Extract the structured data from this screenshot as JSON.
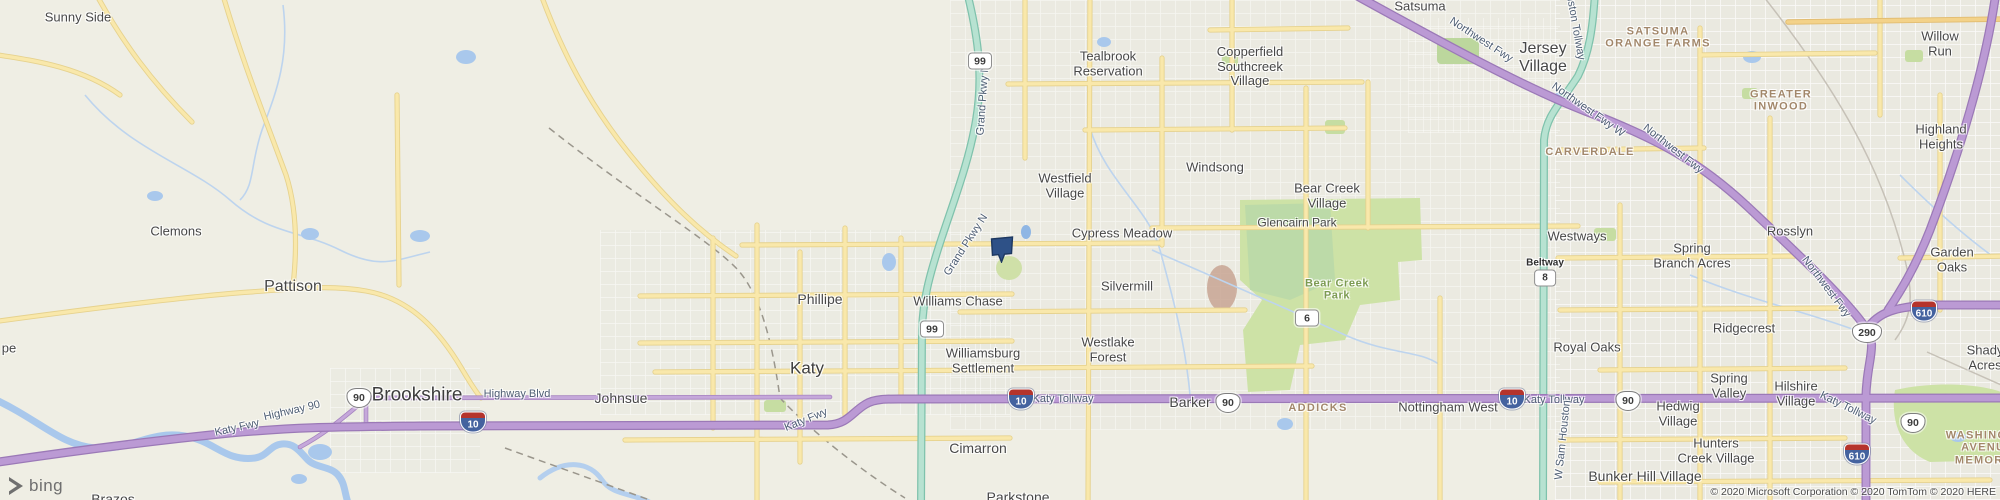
{
  "map": {
    "provider_logo_text": "bing",
    "attribution": "© 2020 Microsoft Corporation © 2020 TomTom © 2020 HERE",
    "colors": {
      "background": "#efeee4",
      "freeway_purple": "#bb9ad4",
      "freeway_purple_casing": "#9b79b7",
      "tollway_teal": "#b7e2d1",
      "tollway_teal_casing": "#7fc2ac",
      "road_yellow": "#f9e8ab",
      "park_green": "#cde2a6",
      "water_blue": "#a9c8ec",
      "marker_navy": "#2e5187"
    },
    "marker": {
      "x": 1002,
      "y": 249
    },
    "labels": [
      {
        "id": "sunny-side",
        "text": "Sunny Side",
        "x": 78,
        "y": 18,
        "cls": "town"
      },
      {
        "id": "clemons",
        "text": "Clemons",
        "x": 176,
        "y": 232,
        "cls": "town"
      },
      {
        "id": "pe-partial",
        "text": "pe",
        "x": 9,
        "y": 349,
        "cls": "town"
      },
      {
        "id": "pattison",
        "text": "Pattison",
        "x": 293,
        "y": 287,
        "cls": "town",
        "fs": 16
      },
      {
        "id": "brookshire",
        "text": "Brookshire",
        "x": 417,
        "y": 395,
        "cls": "city",
        "fs": 19
      },
      {
        "id": "johnsue",
        "text": "Johnsue",
        "x": 621,
        "y": 399,
        "cls": "town",
        "fs": 14
      },
      {
        "id": "katy",
        "text": "Katy",
        "x": 807,
        "y": 368,
        "cls": "city"
      },
      {
        "id": "phillipe",
        "text": "Phillipe",
        "x": 820,
        "y": 300,
        "cls": "town",
        "fs": 14
      },
      {
        "id": "williams-chase",
        "text": "Williams Chase",
        "x": 958,
        "y": 302,
        "cls": "town"
      },
      {
        "id": "williamsburg-settlement",
        "text": "Williamsburg\nSettlement",
        "x": 983,
        "y": 361,
        "cls": "town"
      },
      {
        "id": "cimarron",
        "text": "Cimarron",
        "x": 978,
        "y": 449,
        "cls": "town",
        "fs": 14
      },
      {
        "id": "parkstone",
        "text": "Parkstone",
        "x": 1018,
        "y": 498,
        "cls": "town",
        "fs": 14
      },
      {
        "id": "brazos",
        "text": "Brazos",
        "x": 113,
        "y": 500,
        "cls": "town",
        "fs": 14
      },
      {
        "id": "tealbrook-reservation",
        "text": "Tealbrook\nReservation",
        "x": 1108,
        "y": 64,
        "cls": "town"
      },
      {
        "id": "copperfield-southcreek-village",
        "text": "Copperfield\nSouthcreek\nVillage",
        "x": 1250,
        "y": 67,
        "cls": "town"
      },
      {
        "id": "westfield-village",
        "text": "Westfield\nVillage",
        "x": 1065,
        "y": 186,
        "cls": "town"
      },
      {
        "id": "windsong",
        "text": "Windsong",
        "x": 1215,
        "y": 168,
        "cls": "town"
      },
      {
        "id": "cypress-meadow",
        "text": "Cypress Meadow",
        "x": 1122,
        "y": 234,
        "cls": "town"
      },
      {
        "id": "silvermill",
        "text": "Silvermill",
        "x": 1127,
        "y": 287,
        "cls": "town"
      },
      {
        "id": "bear-creek-village",
        "text": "Bear Creek\nVillage",
        "x": 1327,
        "y": 196,
        "cls": "town"
      },
      {
        "id": "glencairn-park",
        "text": "Glencairn Park",
        "x": 1297,
        "y": 223,
        "cls": "town",
        "fs": 12
      },
      {
        "id": "westlake-forest",
        "text": "Westlake\nForest",
        "x": 1108,
        "y": 350,
        "cls": "town"
      },
      {
        "id": "satsuma",
        "text": "Satsuma",
        "x": 1420,
        "y": 7,
        "cls": "town"
      },
      {
        "id": "jersey-village",
        "text": "Jersey\nVillage",
        "x": 1543,
        "y": 58,
        "cls": "town",
        "fs": 16
      },
      {
        "id": "willow-run",
        "text": "Willow Run",
        "x": 1940,
        "y": 44,
        "cls": "town"
      },
      {
        "id": "highland-heights",
        "text": "Highland\nHeights",
        "x": 1941,
        "y": 137,
        "cls": "town"
      },
      {
        "id": "westways",
        "text": "Westways",
        "x": 1577,
        "y": 237,
        "cls": "town"
      },
      {
        "id": "spring-branch-acres",
        "text": "Spring\nBranch Acres",
        "x": 1692,
        "y": 256,
        "cls": "town"
      },
      {
        "id": "rosslyn",
        "text": "Rosslyn",
        "x": 1790,
        "y": 232,
        "cls": "town"
      },
      {
        "id": "garden-oaks",
        "text": "Garden Oaks",
        "x": 1952,
        "y": 260,
        "cls": "town"
      },
      {
        "id": "ridgecrest",
        "text": "Ridgecrest",
        "x": 1744,
        "y": 329,
        "cls": "town"
      },
      {
        "id": "royal-oaks",
        "text": "Royal Oaks",
        "x": 1587,
        "y": 348,
        "cls": "town"
      },
      {
        "id": "spring-valley",
        "text": "Spring\nValley",
        "x": 1729,
        "y": 386,
        "cls": "town"
      },
      {
        "id": "hilshire-village",
        "text": "Hilshire\nVillage",
        "x": 1796,
        "y": 394,
        "cls": "town"
      },
      {
        "id": "hedwig-village",
        "text": "Hedwig\nVillage",
        "x": 1678,
        "y": 414,
        "cls": "town"
      },
      {
        "id": "nottingham-west",
        "text": "Nottingham West",
        "x": 1448,
        "y": 408,
        "cls": "town"
      },
      {
        "id": "barker",
        "text": "Barker",
        "x": 1190,
        "y": 403,
        "cls": "town",
        "fs": 14
      },
      {
        "id": "hunters-creek-village",
        "text": "Hunters\nCreek Village",
        "x": 1716,
        "y": 451,
        "cls": "town"
      },
      {
        "id": "bunker-hill-village",
        "text": "Bunker Hill Village",
        "x": 1645,
        "y": 477,
        "cls": "town",
        "fs": 14
      },
      {
        "id": "shady-acres",
        "text": "Shady Acres",
        "x": 1985,
        "y": 358,
        "cls": "town"
      },
      {
        "id": "satsuma-orange-farms",
        "text": "SATSUMA\nORANGE FARMS",
        "x": 1658,
        "y": 38,
        "cls": "area"
      },
      {
        "id": "greater-inwood",
        "text": "GREATER\nINWOOD",
        "x": 1781,
        "y": 101,
        "cls": "area"
      },
      {
        "id": "carverdale",
        "text": "CARVERDALE",
        "x": 1590,
        "y": 152,
        "cls": "area"
      },
      {
        "id": "addicks",
        "text": "ADDICKS",
        "x": 1318,
        "y": 408,
        "cls": "area"
      },
      {
        "id": "washington-avenue-memorial",
        "text": "WASHINGTON\nAVENUE-MEMORIAL",
        "x": 1990,
        "y": 448,
        "cls": "area"
      },
      {
        "id": "bear-creek-park",
        "text": "Bear Creek\nPark",
        "x": 1337,
        "y": 290,
        "cls": "park-label"
      },
      {
        "id": "highway-blvd",
        "text": "Highway Blvd",
        "x": 517,
        "y": 394,
        "cls": "roadlbl"
      },
      {
        "id": "katy-fwy-west",
        "text": "Katy Fwy",
        "x": 237,
        "y": 428,
        "cls": "roadlbl",
        "rot": -13
      },
      {
        "id": "highway-90",
        "text": "Highway 90",
        "x": 292,
        "y": 411,
        "cls": "roadlbl",
        "rot": -13
      },
      {
        "id": "katy-fwy-mid",
        "text": "Katy Fwy",
        "x": 806,
        "y": 420,
        "cls": "roadlbl",
        "rot": -22
      },
      {
        "id": "katy-tollway-1",
        "text": "Katy Tollway",
        "x": 1063,
        "y": 399,
        "cls": "roadlbl"
      },
      {
        "id": "katy-tollway-2",
        "text": "Katy Tollway",
        "x": 1554,
        "y": 400,
        "cls": "roadlbl"
      },
      {
        "id": "katy-tollway-3",
        "text": "Katy Tollway",
        "x": 1848,
        "y": 408,
        "cls": "roadlbl",
        "rot": 26
      },
      {
        "id": "grand-pkwy-n-1",
        "text": "Grand Pkwy N",
        "x": 983,
        "y": 100,
        "cls": "roadlbl",
        "rot": -86
      },
      {
        "id": "grand-pkwy-n-2",
        "text": "Grand Pkwy N",
        "x": 966,
        "y": 245,
        "cls": "roadlbl",
        "rot": -57
      },
      {
        "id": "northwest-fwy-1",
        "text": "Northwest Fwy",
        "x": 1481,
        "y": 40,
        "cls": "roadlbl",
        "rot": 33
      },
      {
        "id": "northwest-fwy-w",
        "text": "Northwest Fwy W",
        "x": 1588,
        "y": 110,
        "cls": "roadlbl",
        "rot": 35
      },
      {
        "id": "northwest-fwy-2",
        "text": "Northwest Fwy",
        "x": 1673,
        "y": 149,
        "cls": "roadlbl",
        "rot": 38
      },
      {
        "id": "northwest-fwy-3",
        "text": "Northwest Fwy",
        "x": 1826,
        "y": 287,
        "cls": "roadlbl",
        "rot": 53
      },
      {
        "id": "sam-houston-tollway",
        "text": "Sam Houston Tollway",
        "x": 1572,
        "y": 8,
        "cls": "roadlbl",
        "rot": 80
      },
      {
        "id": "w-sam-houston",
        "text": "W Sam Houston",
        "x": 1563,
        "y": 440,
        "cls": "roadlbl",
        "rot": -84
      }
    ],
    "shields": [
      {
        "id": "sh-99-north",
        "type": "rect",
        "text": "99",
        "x": 980,
        "y": 61
      },
      {
        "id": "sh-99-south",
        "type": "rect",
        "text": "99",
        "x": 932,
        "y": 329
      },
      {
        "id": "sh-6",
        "type": "rect",
        "text": "6",
        "x": 1307,
        "y": 318
      },
      {
        "id": "sh-90-brookshire",
        "type": "us",
        "text": "90",
        "x": 359,
        "y": 398
      },
      {
        "id": "sh-90-barker",
        "type": "us",
        "text": "90",
        "x": 1228,
        "y": 403
      },
      {
        "id": "sh-90-hedwig",
        "type": "us",
        "text": "90",
        "x": 1628,
        "y": 401
      },
      {
        "id": "sh-90-east",
        "type": "us",
        "text": "90",
        "x": 1913,
        "y": 423
      },
      {
        "id": "sh-290",
        "type": "us",
        "text": "290",
        "x": 1867,
        "y": 333
      },
      {
        "id": "sh-10-brookshire",
        "type": "interstate",
        "text": "10",
        "x": 473,
        "y": 422
      },
      {
        "id": "sh-10-katy",
        "type": "interstate",
        "text": "10",
        "x": 1021,
        "y": 399
      },
      {
        "id": "sh-10-east",
        "type": "interstate",
        "text": "10",
        "x": 1512,
        "y": 399
      },
      {
        "id": "sh-610-north",
        "type": "interstate",
        "text": "610",
        "x": 1924,
        "y": 311
      },
      {
        "id": "sh-610-south",
        "type": "interstate",
        "text": "610",
        "x": 1857,
        "y": 454
      },
      {
        "id": "sh-beltway-8",
        "type": "beltway",
        "text": "8",
        "caption": "Beltway",
        "x": 1545,
        "y": 272
      }
    ]
  }
}
